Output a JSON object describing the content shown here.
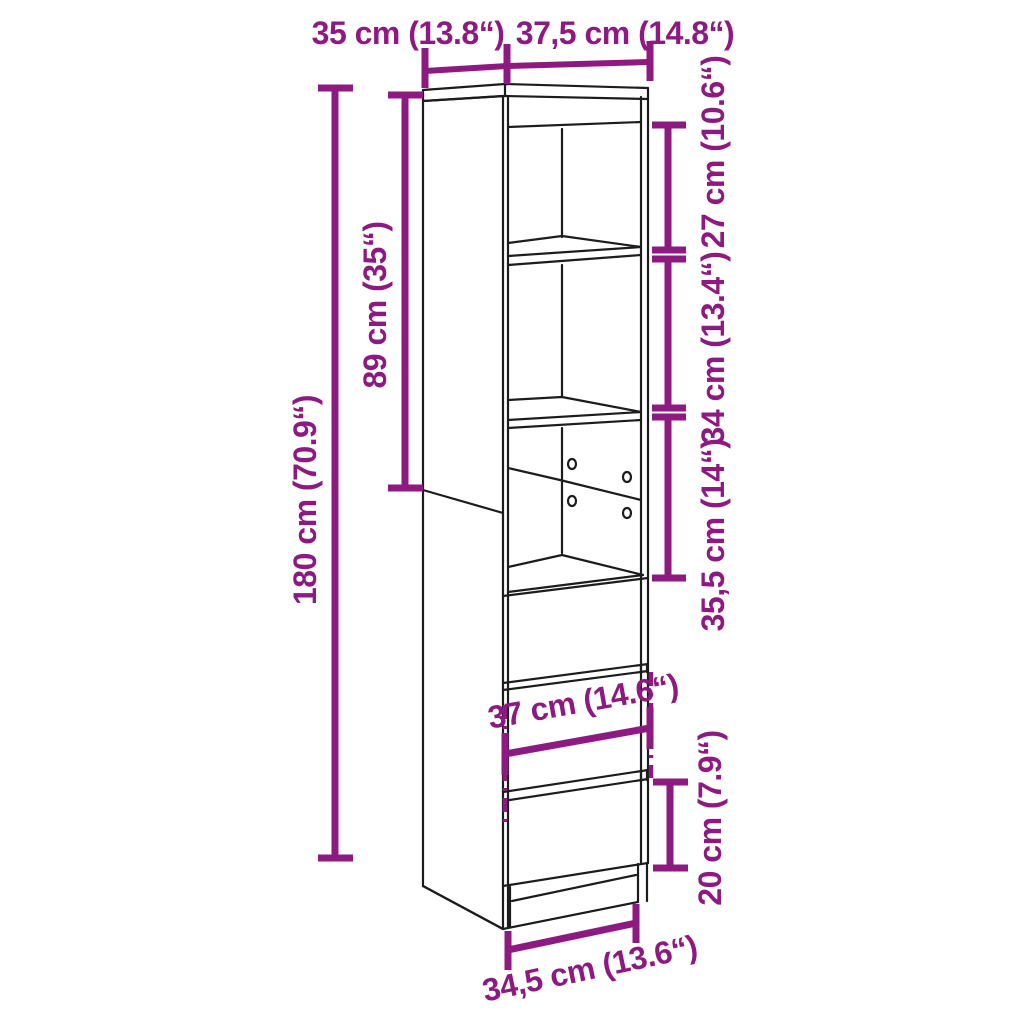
{
  "diagram": {
    "type": "furniture-dimension-diagram",
    "product": "tall-highboard-cabinet-with-open-shelves-and-drawers",
    "colors": {
      "dimension_accent": "#8D1A80",
      "outline": "#1C1C1C",
      "background": "#FFFFFF"
    },
    "dimensions": {
      "top_depth": "35 cm (13.8“)",
      "top_width": "37,5 cm (14.8“)",
      "upper_section_height": "89 cm (35“)",
      "total_height": "180 cm (70.9“)",
      "top_compartment_height": "27 cm (10.6“)",
      "middle_compartment_height": "34 cm (13.4“)",
      "lower_compartment_height": "35,5 cm (14“)",
      "drawer_width": "37 cm (14.6“)",
      "bottom_drawer_height": "20 cm (7.9“)",
      "base_width": "34,5 cm (13.6“)"
    }
  }
}
